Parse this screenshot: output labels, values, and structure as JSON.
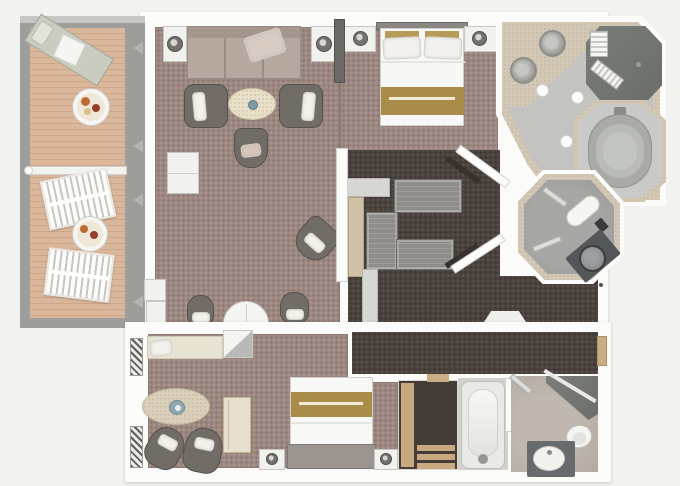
{
  "plan": {
    "title": "two-bedroom-suite-floor-plan",
    "canvas": {
      "width": 680,
      "height": 486
    },
    "palette": {
      "background": "#f2f2f0",
      "wall_white": "#fbfbf9",
      "carpet_mauve": "#9c8781",
      "carpet_dark_brown": "#4b433d",
      "veranda_deck_wood": "#dab69b",
      "veranda_rail_gray": "#9d9d9b",
      "counter_gray_wood": "#8f8d89",
      "counter_tan_wood": "#cfc0a6",
      "marble_tan": "#d2c8b5",
      "marble_gray": "#bdbdbb",
      "shower_gray": "#71746f",
      "tub_gray": "#a8aaa6",
      "fixture_dark_gray": "#54565a",
      "bed_gold_runner": "#a98c49",
      "door_threshold_tan": "#c9ad85",
      "upholstery_taupe": "#b7a89f",
      "chair_dark_gray": "#716c66"
    },
    "areas": {
      "veranda": {
        "furniture": [
          "sun-lounger",
          "round-dining-table",
          "slatted-deck-chair",
          "round-dining-table",
          "slatted-deck-chair",
          "privacy-divider"
        ]
      },
      "living_room": {
        "furniture": [
          "sofa",
          "side-table-lamp",
          "side-table-lamp",
          "armchair",
          "armchair",
          "oval-coffee-table",
          "desk-chair",
          "bar-cabinet",
          "corner-chair",
          "demilune-table",
          "tub-chair",
          "tub-chair",
          "wall-cabinet",
          "wall-cabinet"
        ]
      },
      "master_bedroom": {
        "furniture": [
          "queen-bed",
          "nightstand-lamp",
          "nightstand-lamp"
        ]
      },
      "dressing_area": {
        "furniture": [
          "wardrobe-counter-top",
          "wardrobe-counter-left",
          "wardrobe-counter-bottom",
          "vanity-counter-tan",
          "counter-light",
          "counter-light-lower"
        ]
      },
      "master_bathroom": {
        "fixtures": [
          "double-sink-vanity",
          "walk-in-shower",
          "shower-bench",
          "oval-bathtub",
          "towel-bench"
        ]
      },
      "guest_bathroom": {
        "fixtures": [
          "toilet",
          "corner-sink-vanity",
          "towel-rail",
          "towel-rail"
        ]
      },
      "hallway_upper": {
        "features": [
          "entry-threshold",
          "door-swing",
          "door-handle"
        ]
      },
      "second_bedroom": {
        "furniture": [
          "window-bench",
          "corner-shelf",
          "oval-rug-glass-table",
          "armchair",
          "armchair",
          "desk-cabinet",
          "double-bed",
          "nightstand-lamp",
          "nightstand-lamp",
          "wardrobe-shelves"
        ]
      },
      "second_bathroom": {
        "fixtures": [
          "bathtub",
          "corner-shower",
          "toilet",
          "sink-vanity",
          "towel-rail"
        ]
      },
      "hallway_lower": {
        "features": [
          "entry-door-tan",
          "door-threshold"
        ]
      }
    }
  }
}
